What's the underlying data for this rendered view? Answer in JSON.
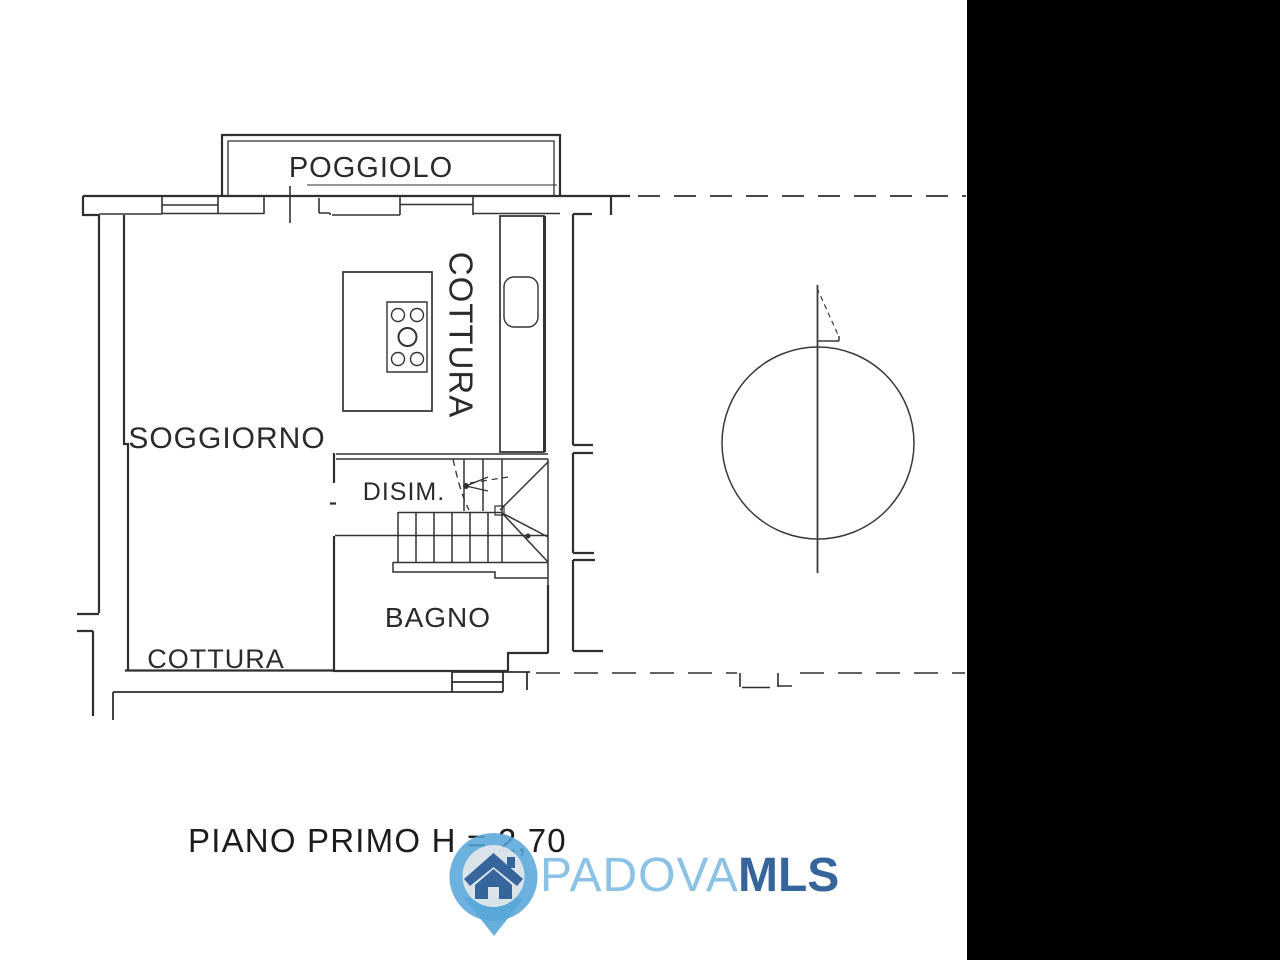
{
  "canvas": {
    "background": "#ffffff",
    "line_color": "#2f2f2f",
    "black_panel_color": "#000000"
  },
  "rooms": {
    "balcony": "POGGIOLO",
    "living_room": "SOGGIORNO",
    "kitchen_column": "COTTURA",
    "hallway": "DISIM.",
    "bathroom": "BAGNO",
    "kitchenette": "COTTURA"
  },
  "plan": {
    "title": "PIANO PRIMO H = 2,70",
    "floor_height": "2,70"
  },
  "watermark": {
    "brand_primary": "PADOVA",
    "brand_secondary": "MLS",
    "pin_color": "#57a7d9",
    "pin_inner_color": "#e9e9ea",
    "house_color": "#36659b",
    "brand_primary_color": "#8cc2e6",
    "brand_secondary_color": "#35659b"
  }
}
